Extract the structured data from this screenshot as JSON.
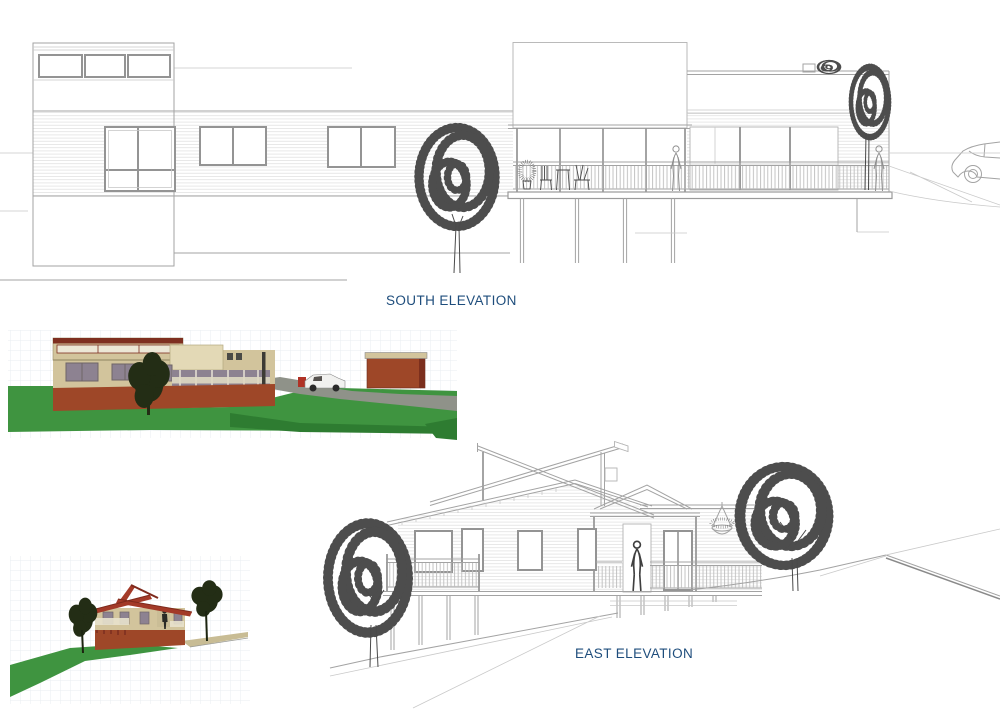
{
  "labels": {
    "south": {
      "text": "SOUTH ELEVATION"
    },
    "east": {
      "text": "EAST ELEVATION"
    }
  },
  "colors": {
    "label_blue": "#1e4d7c",
    "wall_tan": "#d2c49c",
    "wall_tan_light": "#e3d9b6",
    "trim_maroon": "#7e2f20",
    "roof_red": "#a33a28",
    "base_terracotta": "#9e4728",
    "grass": "#3f9440",
    "grass_dark": "#2e7c31",
    "drive_gray": "#8f9289",
    "glass_gray": "#8d8291",
    "tree_dark": "#232d15",
    "truck_white": "#f1f1ef",
    "truck_red": "#b03226",
    "grid": "#e8edf2"
  },
  "drawings": {
    "south_elevation": {
      "kind": "line elevation",
      "content": "single-storey house with clerestory windows, weatherboard siding, long deck with balustrade on piers, two people, outdoor furniture, two trees, vehicle at right"
    },
    "east_elevation": {
      "kind": "line elevation",
      "content": "house on sloping site with crossing skillion clerestory roof, porch gable, person on deck, hanging basket, two trees, hillside ground lines"
    },
    "south_render": {
      "kind": "colored render",
      "content": "tan house with terracotta base on green lawn, driveway, white utility truck, red shed, dark tree"
    },
    "east_render": {
      "kind": "colored render",
      "content": "tan house with red butterfly roof and terracotta base on green slope with two dark trees"
    }
  }
}
